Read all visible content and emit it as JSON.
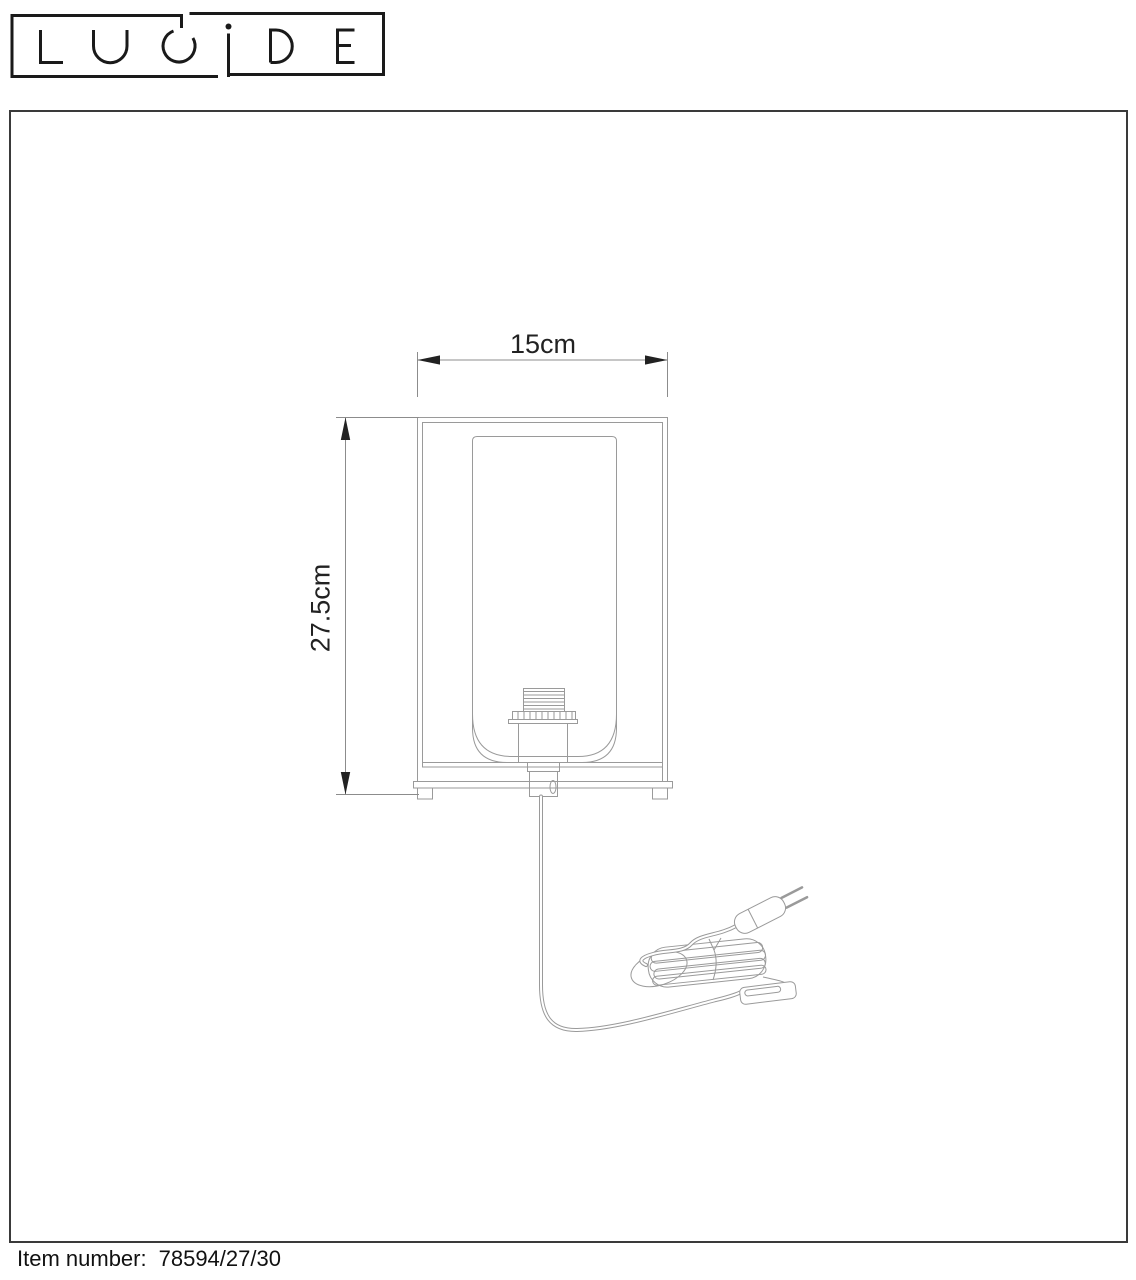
{
  "logo": {
    "text": "LUCIDE"
  },
  "dimensions": {
    "width": "15cm",
    "height": "27.5cm"
  },
  "footer": {
    "label": "Item number:",
    "value": "78594/27/30"
  },
  "drawing": {
    "type": "technical-line-drawing",
    "subject": "table lamp with rectangular frame, glass shade, E27 socket, power cord with euro plug and inline switch"
  },
  "colors": {
    "drawing_line": "#9a9a9a",
    "dimension_line": "#8c8c8c",
    "dimension_text": "#222222",
    "frame_border": "#3a3a3a",
    "logo_ink": "#1a1a1a",
    "footer_text": "#111111",
    "background": "#ffffff"
  }
}
